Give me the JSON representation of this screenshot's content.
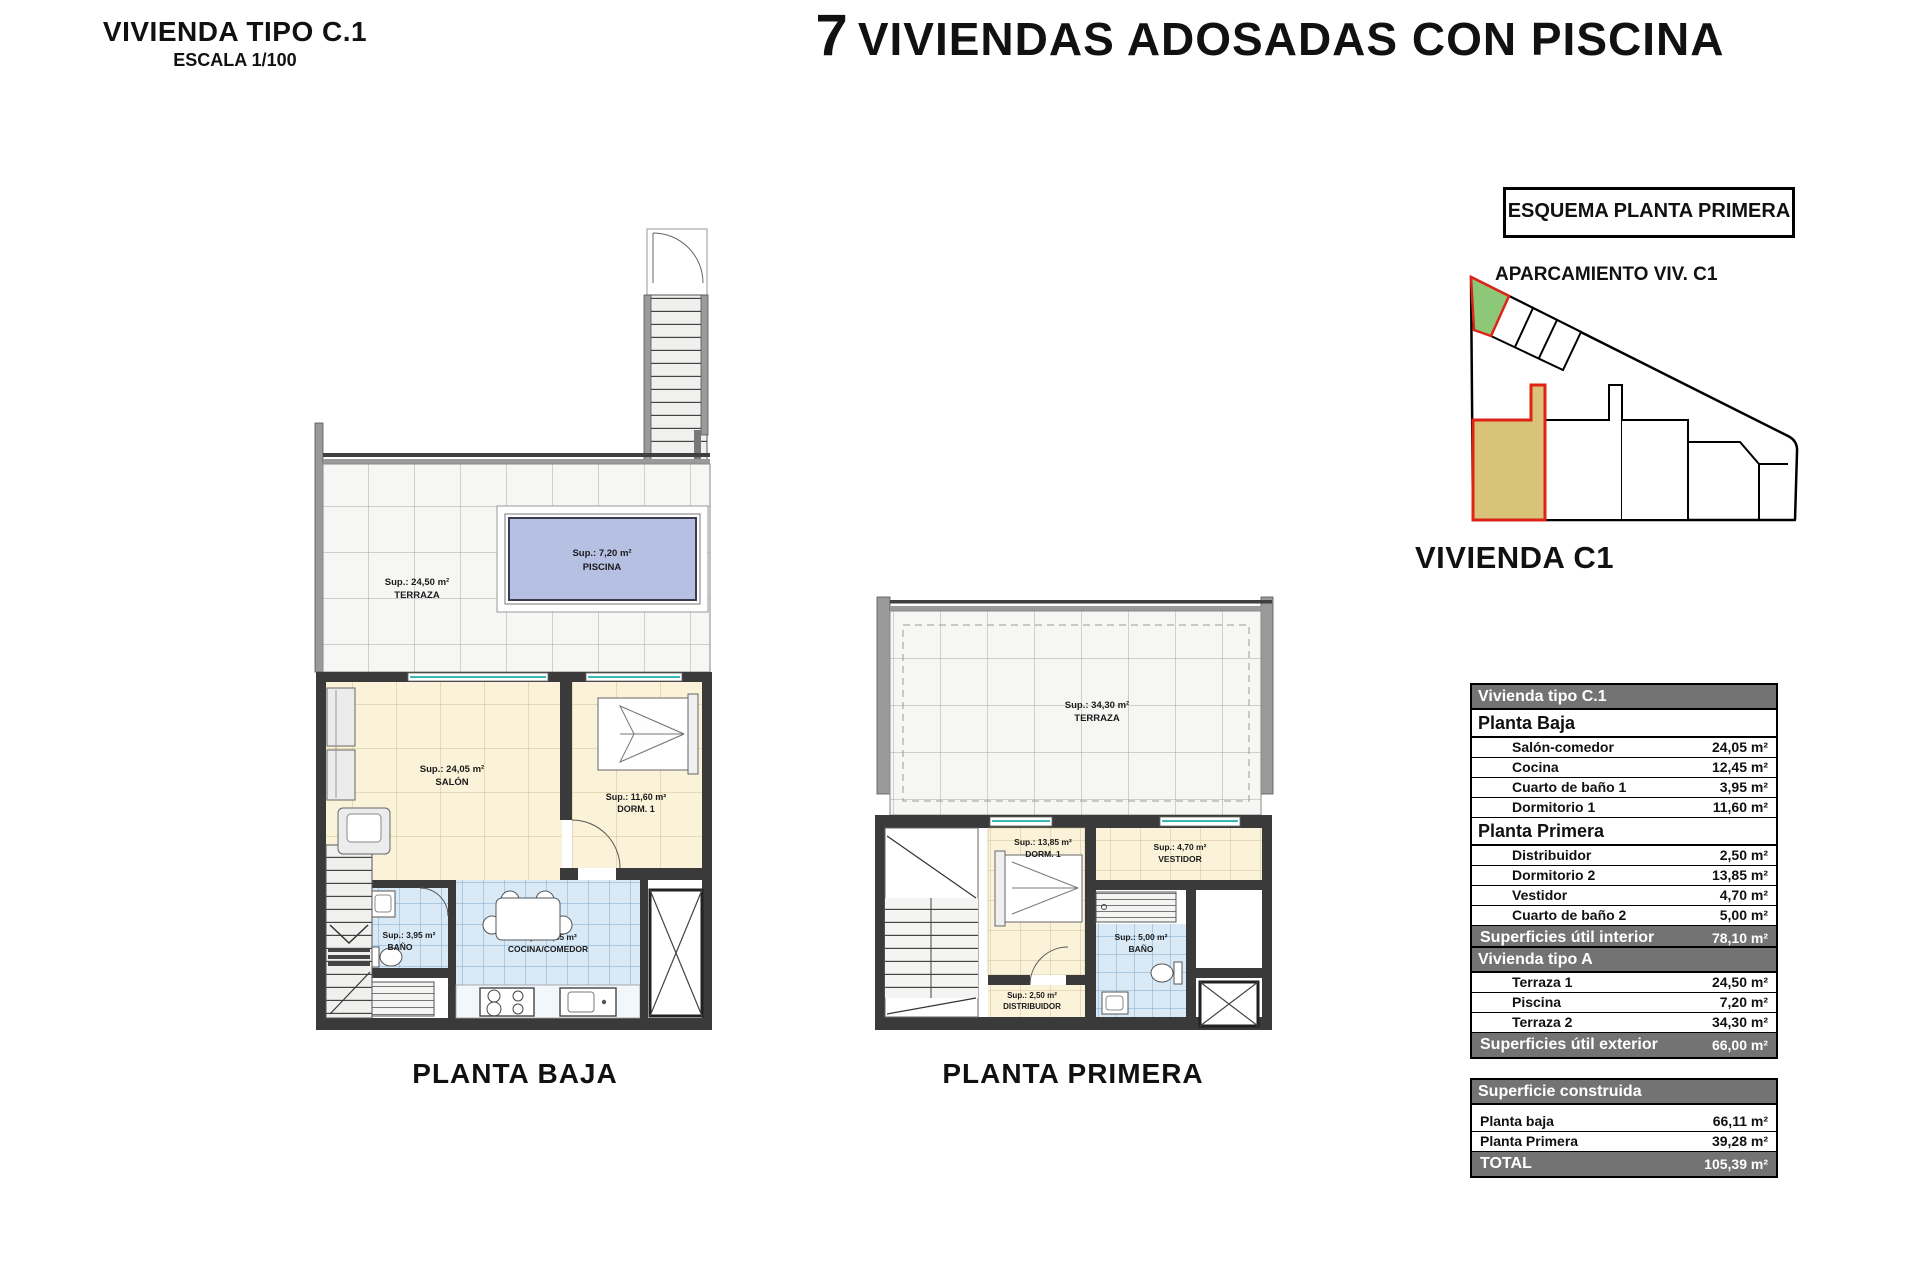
{
  "header": {
    "plan_title": "VIVIENDA TIPO C.1",
    "scale": "ESCALA 1/100",
    "main_title_number": "7",
    "main_title_rest": "VIVIENDAS ADOSADAS CON PISCINA"
  },
  "esquema": {
    "title": "ESQUEMA PLANTA PRIMERA",
    "parking_label": "APARCAMIENTO VIV. C1",
    "vivienda_label": "VIVIENDA C1"
  },
  "colors": {
    "pool": "#b6c0e3",
    "green_plot": "#8cc878",
    "tan_plot": "#d9c379",
    "red_outline": "#e02318"
  },
  "plans": {
    "planta_baja": {
      "caption": "PLANTA BAJA",
      "rooms": {
        "terraza": {
          "sup": "Sup.: 24,50 m²",
          "name": "TERRAZA"
        },
        "piscina": {
          "sup": "Sup.: 7,20 m²",
          "name": "PISCINA"
        },
        "salon": {
          "sup": "Sup.: 24,05 m²",
          "name": "SALÓN"
        },
        "dorm1": {
          "sup": "Sup.: 11,60 m²",
          "name": "DORM. 1"
        },
        "bano": {
          "sup": "Sup.: 3,95 m²",
          "name": "BAÑO"
        },
        "cocina": {
          "sup": "Sup.: 12,45 m²",
          "name": "COCINA/COMEDOR"
        }
      }
    },
    "planta_primera": {
      "caption": "PLANTA PRIMERA",
      "rooms": {
        "terraza": {
          "sup": "Sup.: 34,30 m²",
          "name": "TERRAZA"
        },
        "dorm": {
          "sup": "Sup.: 13,85 m²",
          "name": "DORM. 1"
        },
        "vestidor": {
          "sup": "Sup.: 4,70 m²",
          "name": "VESTIDOR"
        },
        "bano": {
          "sup": "Sup.: 5,00 m²",
          "name": "BAÑO"
        },
        "distribuidor": {
          "sup": "Sup.: 2,50 m²",
          "name": "DISTRIBUIDOR"
        }
      }
    }
  },
  "tables": [
    {
      "header": "Vivienda tipo C.1",
      "sections": [
        {
          "title": "Planta Baja",
          "rows": [
            {
              "label": "Salón-comedor",
              "value": "24,05 m²"
            },
            {
              "label": "Cocina",
              "value": "12,45 m²"
            },
            {
              "label": "Cuarto de baño 1",
              "value": "3,95 m²"
            },
            {
              "label": "Dormitorio 1",
              "value": "11,60 m²"
            }
          ]
        },
        {
          "title": "Planta Primera",
          "rows": [
            {
              "label": "Distribuidor",
              "value": "2,50 m²"
            },
            {
              "label": "Dormitorio 2",
              "value": "13,85 m²"
            },
            {
              "label": "Vestidor",
              "value": "4,70 m²"
            },
            {
              "label": "Cuarto de baño 2",
              "value": "5,00 m²"
            }
          ]
        }
      ],
      "footer": {
        "label": "Superficies útil interior",
        "value": "78,10 m²"
      }
    },
    {
      "header": "Vivienda tipo A",
      "sections": [
        {
          "title": "",
          "rows": [
            {
              "label": "Terraza 1",
              "value": "24,50 m²"
            },
            {
              "label": "Piscina",
              "value": "7,20 m²"
            },
            {
              "label": "Terraza 2",
              "value": "34,30 m²"
            }
          ]
        }
      ],
      "footer": {
        "label": "Superficies útil exterior",
        "value": "66,00 m²"
      }
    },
    {
      "header": "Superficie construida",
      "gap": true,
      "indent": false,
      "sections": [
        {
          "title": "",
          "rows": [
            {
              "label": "Planta baja",
              "value": "66,11 m²"
            },
            {
              "label": "Planta Primera",
              "value": "39,28 m²"
            }
          ]
        }
      ],
      "footer": {
        "label": "TOTAL",
        "value": "105,39 m²"
      }
    }
  ]
}
